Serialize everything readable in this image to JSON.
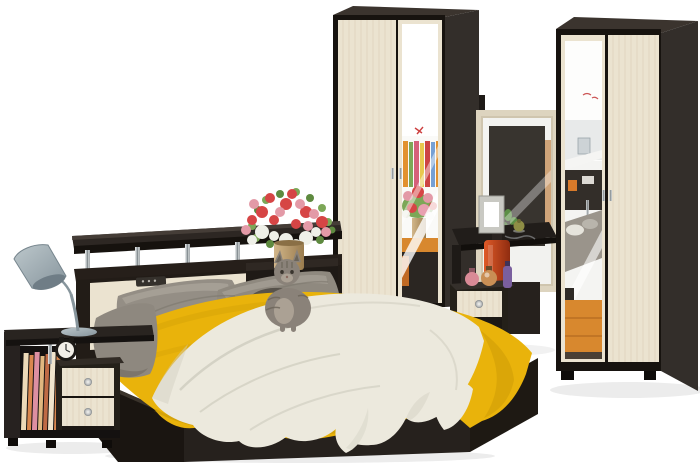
{
  "scene": {
    "type": "product-photo",
    "description": "Studio photo of a wenge-and-light-oak bedroom set: double bed with yellow bedspread, white knitted throw, grey pillows and a tabby cat; headboard shelf on chrome posts holding a remote and a bouquet in a tan vase; grey floor lamp over a two-drawer bedside unit with striped books and an alarm clock; central two-door wardrobe with mirror; dressing table with mirror, photo frame, trinket box, jewellery, red vase, perfume bottles and a one-drawer cabinet; right two-door mirrored wardrobe.",
    "objects": [
      {
        "name": "floor-lamp",
        "color_note": "grey-blue cone shade"
      },
      {
        "name": "bedside-shelf-unit",
        "color_note": "wenge with two light drawers, striped books, black alarm clock"
      },
      {
        "name": "double-bed",
        "color_note": "wenge frame, light headboard insert, chrome shelf posts"
      },
      {
        "name": "pillows",
        "color_note": "two grey pillows, one dark knitted cushion"
      },
      {
        "name": "bedspread",
        "color_note": "mustard yellow"
      },
      {
        "name": "throw-blanket",
        "color_note": "off-white knitted"
      },
      {
        "name": "bouquet-in-vase",
        "color_note": "red, pink and white flowers in tan vase"
      },
      {
        "name": "cat",
        "color_note": "grey tabby sitting on the bed"
      },
      {
        "name": "remote-control",
        "color_note": "on headboard shelf"
      },
      {
        "name": "wardrobe-center",
        "color_note": "wenge carcass, light oak door plus mirror door"
      },
      {
        "name": "dressing-table",
        "color_note": "mirror in light frame, photo frame, trinket, jewellery, red vase, perfumes, one-drawer cabinet"
      },
      {
        "name": "wardrobe-right",
        "color_note": "mirror door plus light oak door, wenge side"
      }
    ]
  },
  "palette": {
    "background": "#ffffff",
    "wenge_front": "#26211d",
    "wenge_dark": "#17130f",
    "wenge_side": "#332e2a",
    "wenge_top": "#3b342e",
    "cream_panel": "#ebe3d0",
    "cream_grain": "#d8ccb1",
    "mirror_frame": "#ddd4bf",
    "mirror_glass": "#f2f2ef",
    "yellow_spread": "#e9b30b",
    "yellow_shadow": "#c49305",
    "blanket_white": "#ece9dd",
    "blanket_shadow": "#d2cfc2",
    "pillow_gray": "#948e85",
    "pillow_dark": "#6f695f",
    "cushion_dark": "#57524a",
    "lamp_gray": "#9fadb3",
    "vase_tan": "#c0a273",
    "flower_red": "#d64545",
    "flower_pink": "#e39aa7",
    "flower_white": "#eff0e8",
    "leaf_green": "#7ca757",
    "floor_orange": "#d8882e",
    "cat_gray": "#8a8279",
    "vanity_vase_red": "#c8441e",
    "shadow": "#ececec"
  }
}
